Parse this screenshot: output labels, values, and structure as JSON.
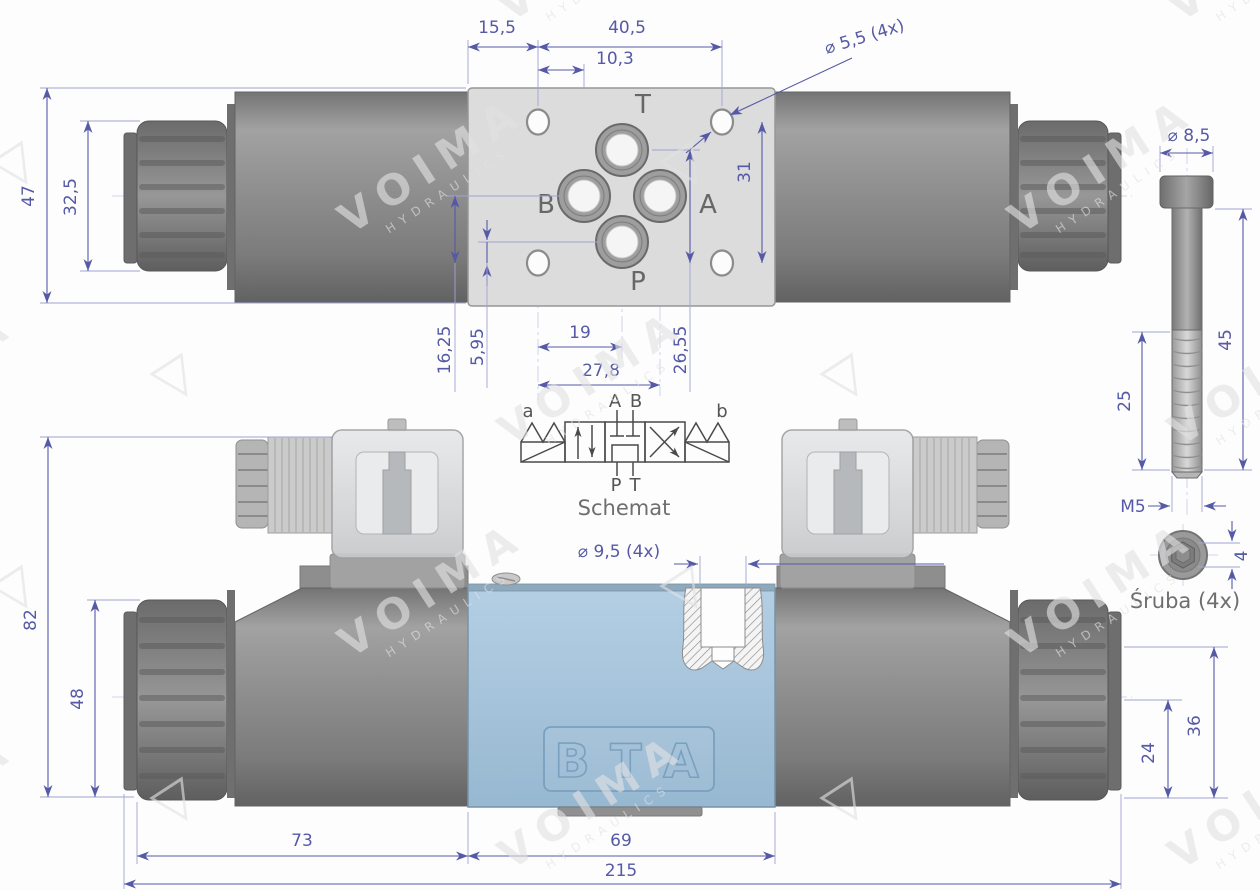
{
  "colors": {
    "dimension": "#5559a6",
    "body_blue": "#a8c6dd",
    "body_gray": "#8a8a8a",
    "caption_gray": "#6e6e6e",
    "watermark_gray": "#e2e2e4"
  },
  "watermark": {
    "brand": "VOIMA",
    "sub": "HYDRAULICS",
    "logo_glyph": "▽"
  },
  "top_view": {
    "port_labels": {
      "t": "T",
      "b": "B",
      "a": "A",
      "p": "P"
    },
    "dims": {
      "edge_to_hole": "15,5",
      "hole_span": "40,5",
      "hole_to_port": "10,3",
      "mount_hole_dia": "⌀ 5,5 (4x)",
      "plate_height": "47",
      "nut_height": "32,5",
      "hole_span_vertical": "31",
      "port_row_to_hole": "16,25",
      "p_port_to_hole": "5,95",
      "hole_to_t_col": "19",
      "hole_to_a_col": "27,8",
      "t_port_to_hole": "26,55"
    }
  },
  "schematic": {
    "caption": "Schemat",
    "labels": {
      "solenoid_a": "a",
      "solenoid_b": "b",
      "port_a": "A",
      "port_b": "B",
      "port_p": "P",
      "port_t": "T"
    }
  },
  "screw": {
    "caption": "Śruba (4x)",
    "dims": {
      "head_dia": "⌀ 8,5",
      "shank_length": "45",
      "thread_length": "25",
      "thread_size": "M5",
      "hex_socket": "4"
    }
  },
  "bottom_view": {
    "body_letters": [
      "B",
      "T",
      "A"
    ],
    "dims": {
      "counterbore_dia": "⌀ 9,5 (4x)",
      "total_height": "82",
      "nut_height": "48",
      "right_upper": "36",
      "right_lower": "24",
      "solenoid_length": "73",
      "body_length": "69",
      "total_length": "215"
    }
  }
}
